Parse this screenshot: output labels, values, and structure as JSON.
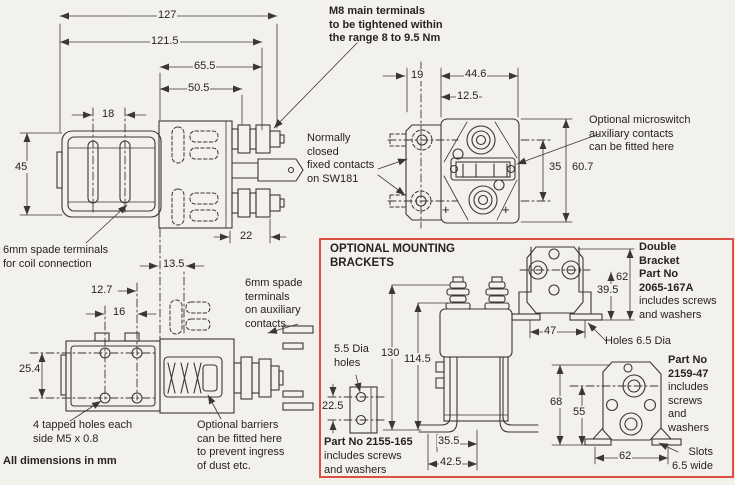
{
  "colors": {
    "bg": "#f3f1ec",
    "line": "#3b3733",
    "text": "#262320",
    "accent": "#dd4f42"
  },
  "notes": {
    "m8": "M8 main terminals\nto be tightened within\nthe range 8 to 9.5 Nm",
    "normally_closed": "Normally\nclosed\nfixed contacts\non SW181",
    "microswitch": "Optional microswitch\nauxiliary contacts\ncan be fitted here",
    "coil_terminals": "6mm spade terminals\nfor coil connection",
    "aux_terminals": "6mm spade\nterminals\non auxiliary\ncontacts",
    "tapped_holes": "4 tapped holes each\nside M5 x 0.8",
    "barriers": "Optional barriers\ncan be fitted here\nto prevent ingress\nof dust etc.",
    "all_dims": "All dimensions in mm"
  },
  "dims": {
    "d127": "127",
    "d121_5": "121.5",
    "d65_5": "65.5",
    "d50_5": "50.5",
    "d18": "18",
    "d45": "45",
    "d22": "22",
    "d13_5": "13.5",
    "d12_7": "12.7",
    "d16": "16",
    "d25_4": "25.4",
    "d19": "19",
    "d44_6": "44.6",
    "d12_5": "12.5",
    "d35": "35",
    "d60_7": "60.7",
    "plus": "+"
  },
  "bracket_box": {
    "title": "OPTIONAL MOUNTING\nBRACKETS",
    "dia_holes": "5.5 Dia\nholes",
    "holes_dia": "Holes 6.5 Dia",
    "slots": "Slots\n6.5 wide",
    "single_bracket": {
      "part": "Part No 2155-165",
      "includes": "includes screws\nand washers"
    },
    "double_bracket": {
      "name": "Double\nBracket",
      "part": "Part No\n2065-167A",
      "includes": "includes screws\nand washers"
    },
    "foot_bracket": {
      "part": "Part No\n2159-47",
      "includes": "includes\nscrews\nand\nwashers"
    },
    "dims": {
      "d130": "130",
      "d114_5": "114.5",
      "d22_5": "22.5",
      "d35_5": "35.5",
      "d42_5": "42.5",
      "d62": "62",
      "d39_5": "39.5",
      "d47": "47",
      "d68": "68",
      "d55": "55",
      "d62_base": "62"
    }
  }
}
